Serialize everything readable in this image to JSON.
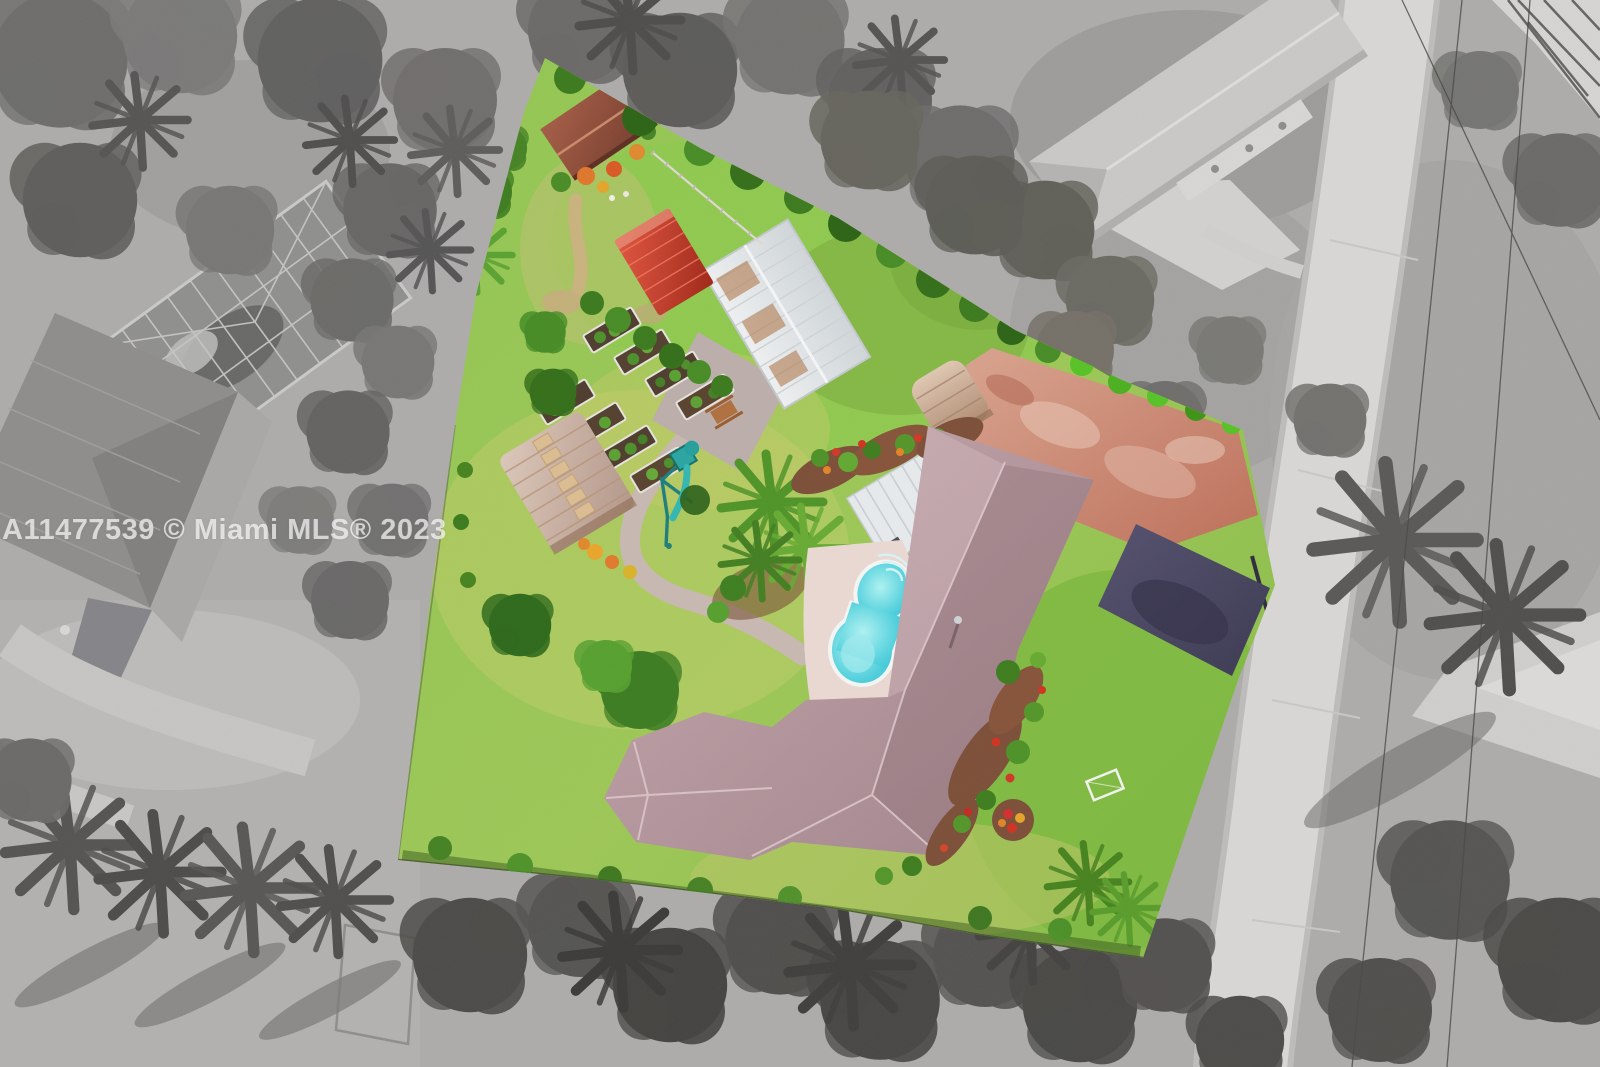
{
  "watermark": {
    "text": "A11477539 © Miami MLS® 2023"
  },
  "scene": {
    "type": "aerial-drone-photo",
    "description": "Overhead drone photo of a residential acreage lot shown in full color while the surrounding neighborhood is desaturated to grayscale; a curving street runs along the right side.",
    "highlighted_lot": {
      "features": [
        "mauve-shingle-ranch-house",
        "freeform-swimming-pool",
        "pool-deck",
        "white-metal-carport-roof",
        "tiki-hut",
        "thatched-pavilion",
        "red-metal-shed",
        "greenhouse-with-skylights",
        "raised-garden-beds",
        "garden-patio-with-picnic-table",
        "teal-playground-swing-set",
        "guest-cottage",
        "red-paver-driveway",
        "dark-asphalt-driveway",
        "paver-walking-path",
        "perimeter-hedges-and-fences",
        "flower-beds-red-orange",
        "palm-trees",
        "green-lawn",
        "soccer-goal"
      ]
    },
    "surroundings": [
      "left-neighbor-house-with-screened-pool-enclosure",
      "top-right-neighbor-house-with-driveway",
      "curving-street",
      "side-driveway-aprons",
      "overhead-power-lines",
      "palm-tree-rows-with-long-shadows",
      "dense-tree-canopy"
    ],
    "palette": {
      "grass_bright": "#8cc44e",
      "grass_yellow": "#b9cc66",
      "grass_deep": "#76b23c",
      "roof_mauve": "#b3979e",
      "pool_turquoise": "#3cc9da",
      "pool_deck": "#ead9d3",
      "shed_red": "#cf4430",
      "greenhouse_silver": "#e2e5e7",
      "skylight_amber": "#b07a4e",
      "pavement_red": "#c98169",
      "asphalt_navy": "#4a4764",
      "thatch_tan": "#cdaa8c",
      "cottage_roof": "#95563f",
      "hedge_green": "#3f7d22",
      "flower_red": "#cf3322",
      "flower_orange": "#e08428",
      "play_teal": "#2ba5a1",
      "road_gray": "#d7d6d4",
      "ground_gray": "#aeadab",
      "tree_gray": "#6c6b69",
      "tree_dark": "#4c4b49",
      "watermark_white": "#ffffff"
    }
  }
}
